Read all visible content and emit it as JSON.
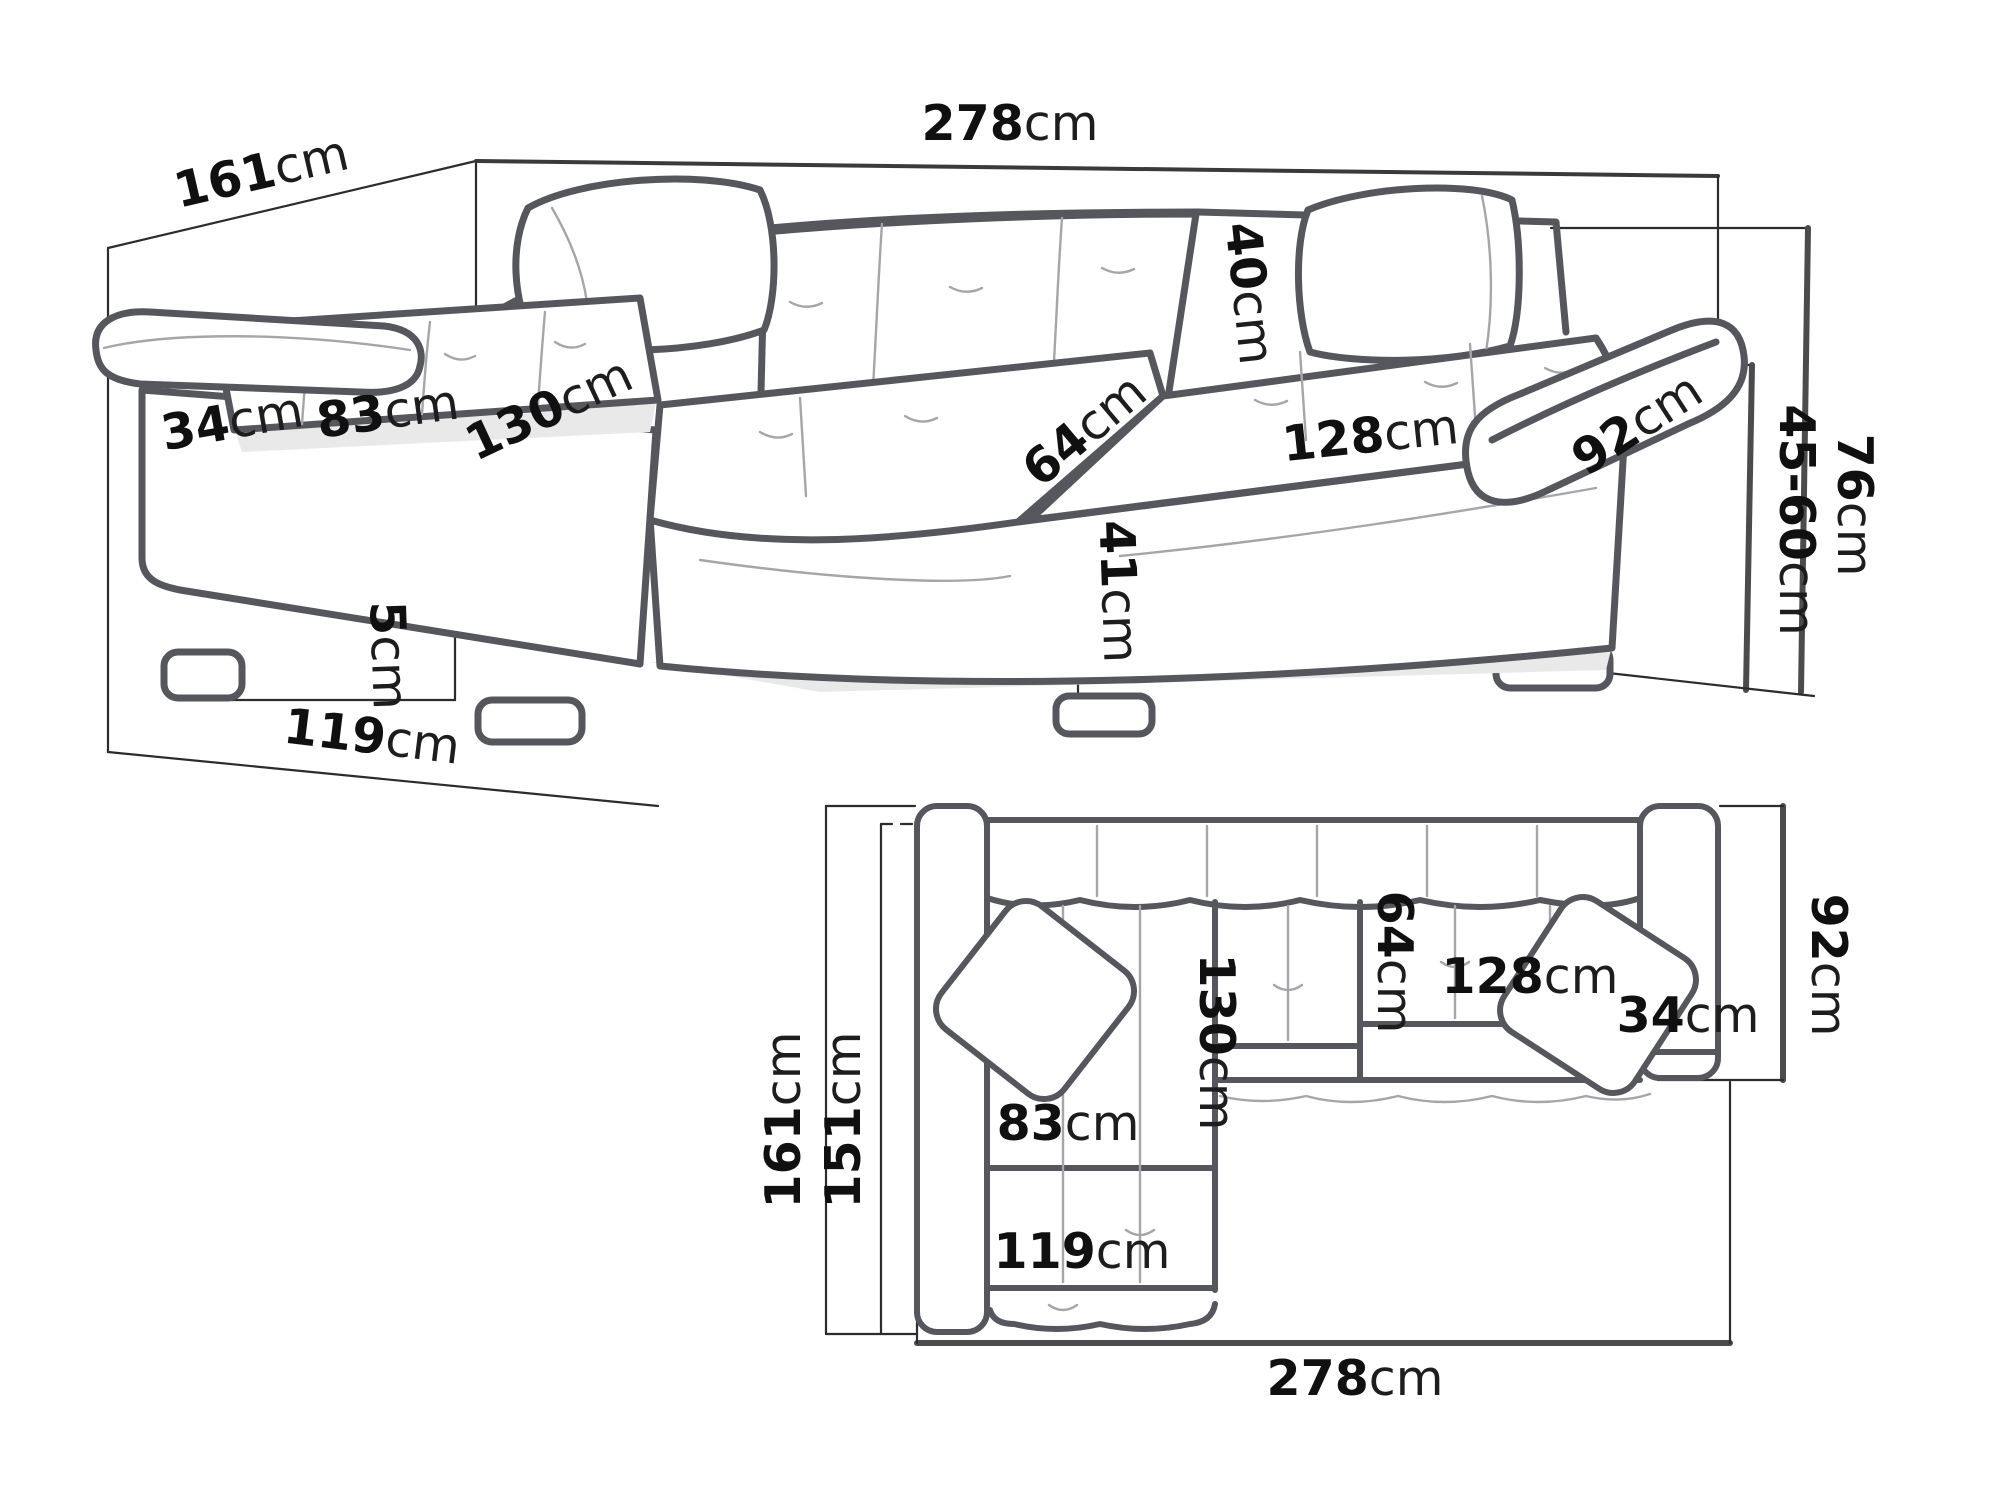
{
  "colors": {
    "background": "#ffffff",
    "sketch_outline": "#55575c",
    "detail_line": "#a6a6aa",
    "dimension_line": "#2c2c2e",
    "label_ink": "#101010"
  },
  "perspective_view": {
    "dims": {
      "d161": {
        "value": "161",
        "unit": "cm"
      },
      "d278": {
        "value": "278",
        "unit": "cm"
      },
      "d34": {
        "value": "34",
        "unit": "cm"
      },
      "d83": {
        "value": "83",
        "unit": "cm"
      },
      "d130": {
        "value": "130",
        "unit": "cm"
      },
      "d40": {
        "value": "40",
        "unit": "cm"
      },
      "d64": {
        "value": "64",
        "unit": "cm"
      },
      "d128": {
        "value": "128",
        "unit": "cm"
      },
      "d92": {
        "value": "92",
        "unit": "cm"
      },
      "d41": {
        "value": "41",
        "unit": "cm"
      },
      "d5": {
        "value": "5",
        "unit": "cm"
      },
      "d45_60": {
        "value": "45-60",
        "unit": "cm"
      },
      "d76": {
        "value": "76",
        "unit": "cm"
      },
      "d119": {
        "value": "119",
        "unit": "cm"
      }
    }
  },
  "plan_view": {
    "dims": {
      "d161": {
        "value": "161",
        "unit": "cm"
      },
      "d151": {
        "value": "151",
        "unit": "cm"
      },
      "d130": {
        "value": "130",
        "unit": "cm"
      },
      "d64": {
        "value": "64",
        "unit": "cm"
      },
      "d128": {
        "value": "128",
        "unit": "cm"
      },
      "d34": {
        "value": "34",
        "unit": "cm"
      },
      "d83": {
        "value": "83",
        "unit": "cm"
      },
      "d119": {
        "value": "119",
        "unit": "cm"
      },
      "d278": {
        "value": "278",
        "unit": "cm"
      },
      "d92": {
        "value": "92",
        "unit": "cm"
      }
    }
  }
}
